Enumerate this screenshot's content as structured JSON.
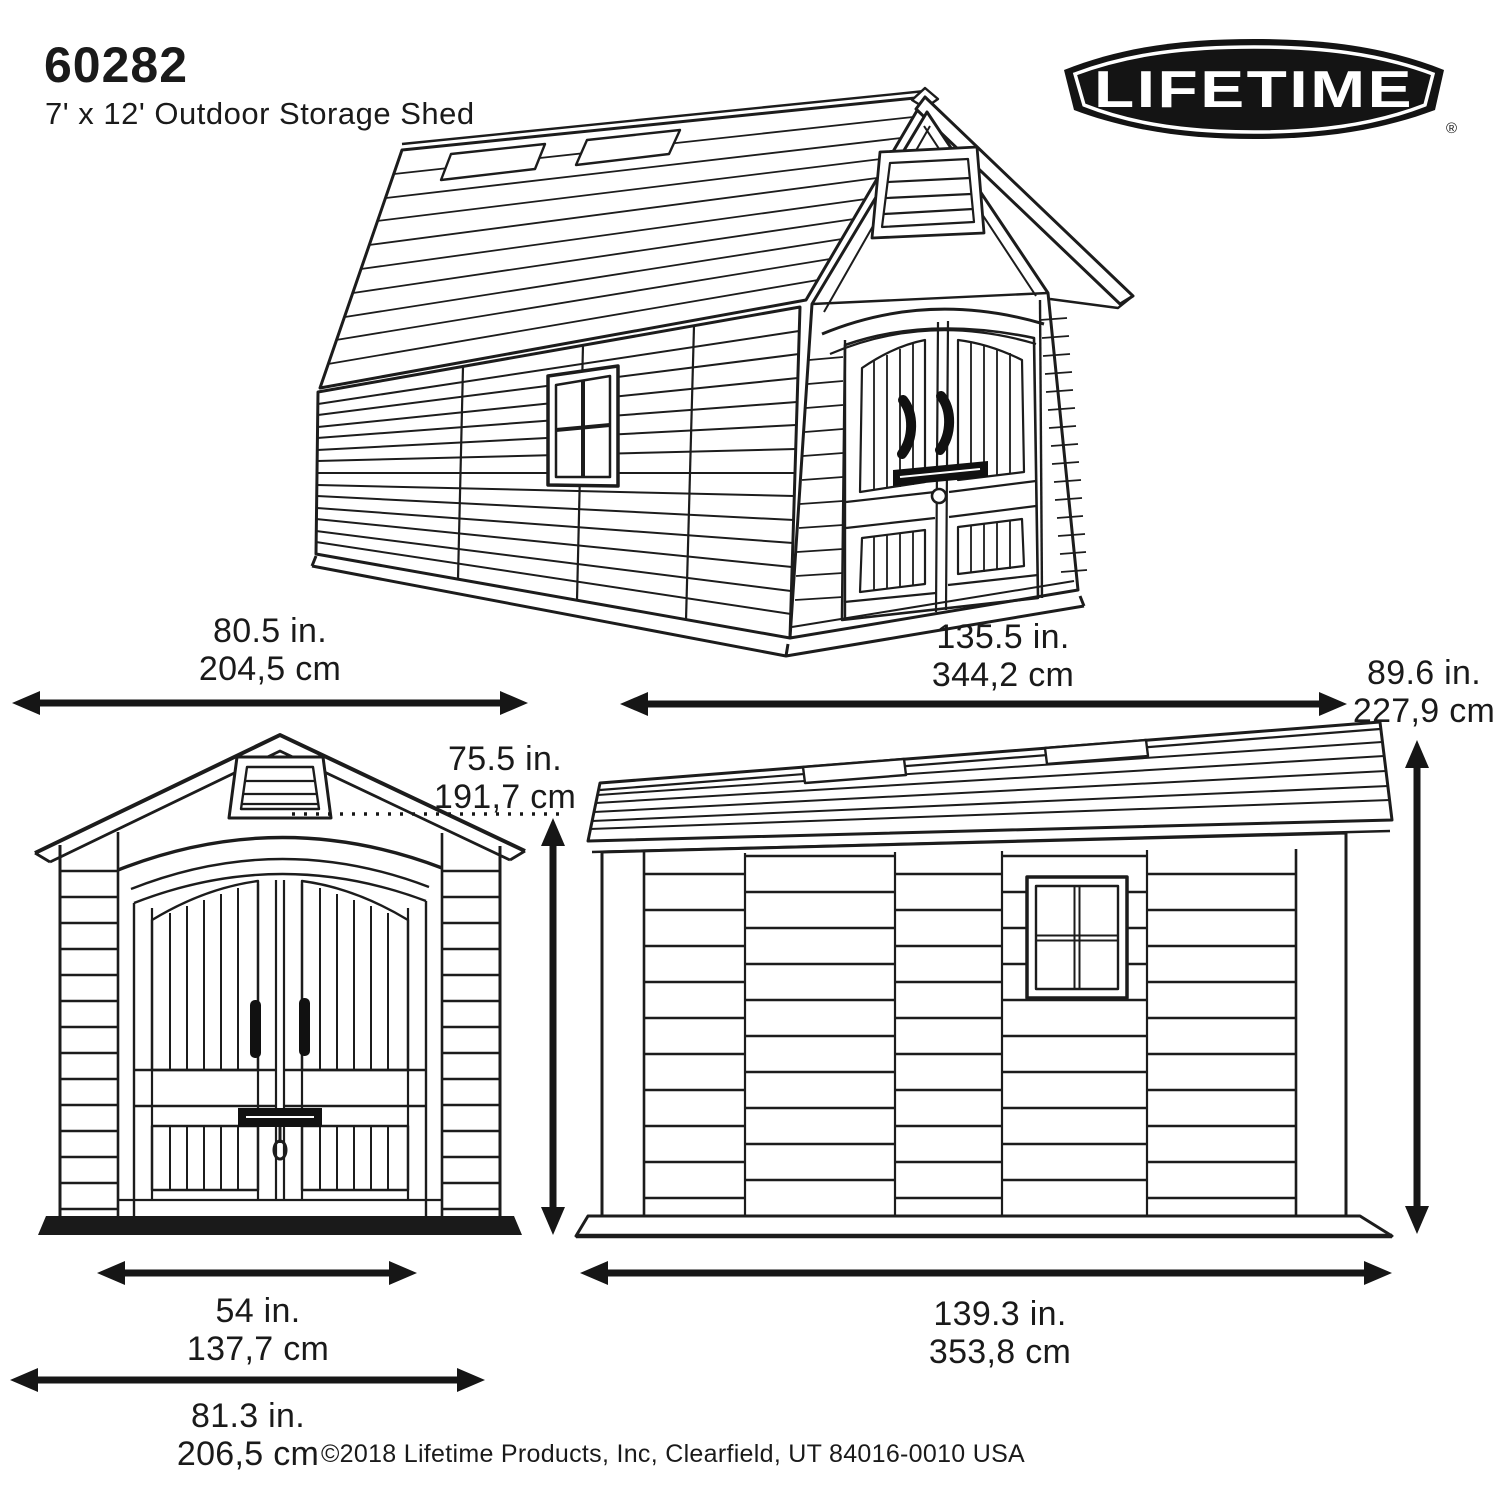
{
  "header": {
    "model_number": "60282",
    "product_name": "7' x 12' Outdoor Storage Shed"
  },
  "brand": {
    "logo_text": "LIFETIME",
    "registered_mark": "®",
    "logo_background": "#141414",
    "logo_foreground": "#ffffff"
  },
  "dimensions": {
    "width_end": {
      "in": "80.5 in.",
      "cm": "204,5 cm"
    },
    "length_overall": {
      "in": "135.5 in.",
      "cm": "344,2 cm"
    },
    "height_overall": {
      "in": "89.6 in.",
      "cm": "227,9 cm"
    },
    "height_door": {
      "in": "75.5 in.",
      "cm": "191,7 cm"
    },
    "width_door": {
      "in": "54 in.",
      "cm": "137,7 cm"
    },
    "width_base": {
      "in": "81.3 in.",
      "cm": "206,5 cm"
    },
    "length_base": {
      "in": "139.3 in.",
      "cm": "353,8 cm"
    }
  },
  "footer": {
    "copyright": "©2018 Lifetime Products, Inc, Clearfield, UT 84016-0010 USA"
  },
  "colors": {
    "line": "#1c1c1c",
    "background": "#ffffff"
  }
}
